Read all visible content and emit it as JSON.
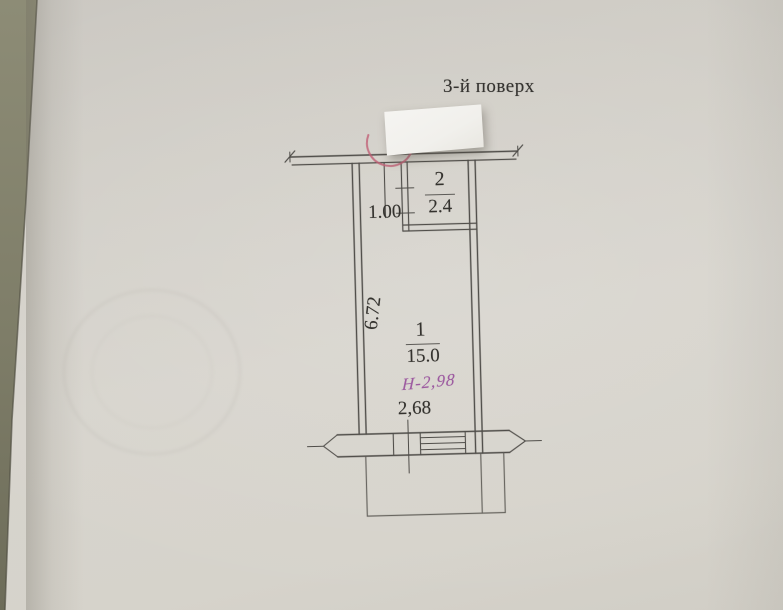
{
  "title": "3-й поверх",
  "plan": {
    "rooms": [
      {
        "number": "1",
        "area": "15.0"
      },
      {
        "number": "2",
        "area": "2.4"
      }
    ],
    "dimensions": {
      "corridor_width": "1.00",
      "room_depth": "6.72",
      "balcony_opening_width": "2,68"
    },
    "handwritten_height_note": "Н-2,98"
  },
  "colors": {
    "paper": "#d5d2cb",
    "desk_surface": "#85846e",
    "line": "#4f4d49",
    "text": "#34322e",
    "red": "#c05f76",
    "purple": "#98519c",
    "sticker": "#f4f3f0"
  }
}
